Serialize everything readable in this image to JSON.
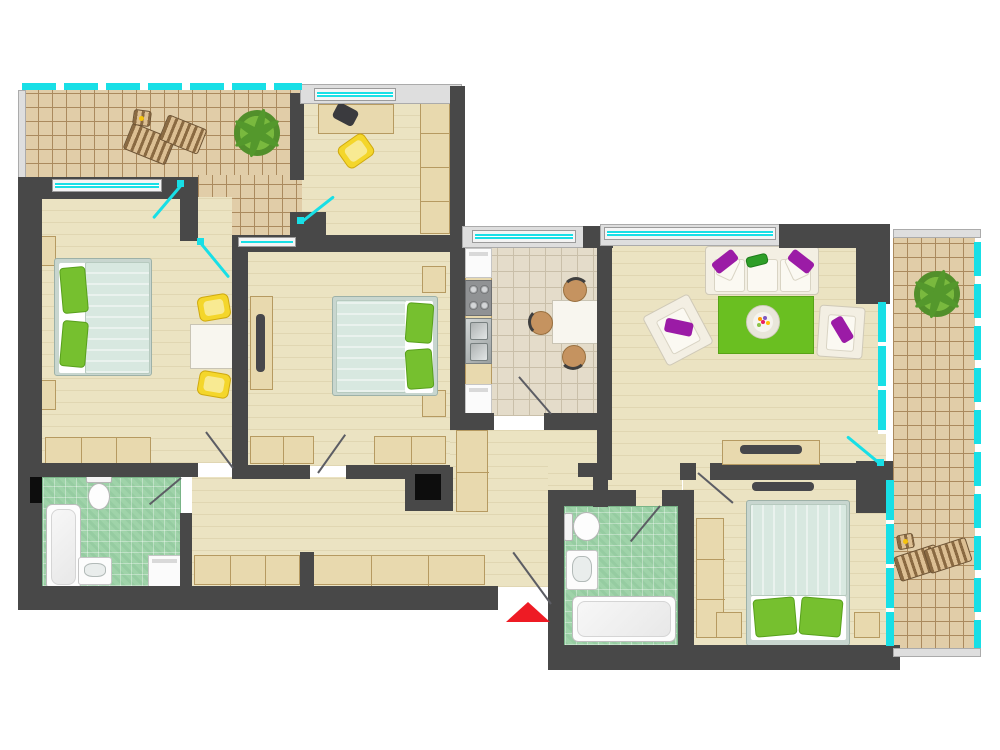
{
  "meta": {
    "kind": "apartment-floor-plan",
    "canvas_w": 1000,
    "canvas_h": 750,
    "visible_text": "none"
  },
  "palette": {
    "wall": "#484848",
    "terr": "#e1cda8",
    "terrline": "#ab8a5e",
    "wood": "#ebe3c2",
    "kit": "#e4dcca",
    "kitline": "#c9bfa9",
    "bath": "#9fd3a9",
    "glass": "#18dfe6",
    "furn": "#e8d9ae",
    "furnline": "#b69a61",
    "blanket": "#d8e8e0",
    "pillow": "#76c02f",
    "sofa": "#f3efe3",
    "purple": "#9b1ba6",
    "rug": "#6abf21",
    "yellow": "#f4d62b",
    "brown": "#c59360",
    "tv": "#47474b",
    "swing": "#5c5d64",
    "red": "#ee1b24"
  },
  "rooms": [
    {
      "id": "terrace-left",
      "name": "Terrace (top-left)",
      "floor": "tile",
      "furniture": [
        "lounge-chair",
        "lounge-chair",
        "side-table",
        "plant"
      ]
    },
    {
      "id": "study",
      "name": "Study",
      "floor": "wood",
      "furniture": [
        "desk",
        "laptop",
        "chair",
        "wardrobe"
      ]
    },
    {
      "id": "bedroom-1",
      "name": "Bedroom 1",
      "floor": "wood",
      "furniture": [
        "double-bed",
        "nightstand",
        "nightstand",
        "table",
        "chair",
        "chair",
        "wardrobe"
      ]
    },
    {
      "id": "bedroom-2",
      "name": "Bedroom 2",
      "floor": "wood",
      "furniture": [
        "double-bed",
        "nightstand",
        "nightstand",
        "dresser-tv",
        "wardrobe",
        "wardrobe"
      ]
    },
    {
      "id": "kitchen",
      "name": "Kitchen",
      "floor": "tile",
      "furniture": [
        "fridge",
        "stove",
        "sink",
        "cabinet",
        "dining-table",
        "chair",
        "chair",
        "chair"
      ]
    },
    {
      "id": "living-room",
      "name": "Living room",
      "floor": "wood",
      "furniture": [
        "sofa",
        "armchair",
        "armchair",
        "rug",
        "coffee-table",
        "tv-stand",
        "tv"
      ]
    },
    {
      "id": "terrace-right",
      "name": "Terrace (right)",
      "floor": "tile",
      "furniture": [
        "plant",
        "lounge-chair",
        "lounge-chair",
        "side-table"
      ]
    },
    {
      "id": "bedroom-3",
      "name": "Bedroom 3",
      "floor": "wood",
      "furniture": [
        "double-bed",
        "nightstand",
        "nightstand",
        "wardrobe",
        "tv"
      ]
    },
    {
      "id": "bathroom-1",
      "name": "Bathroom 1",
      "floor": "green-tile",
      "furniture": [
        "bathtub",
        "toilet",
        "sink",
        "washing-machine"
      ]
    },
    {
      "id": "bathroom-2",
      "name": "Bathroom 2",
      "floor": "green-tile",
      "furniture": [
        "bathtub",
        "toilet",
        "sink"
      ]
    },
    {
      "id": "hallway",
      "name": "Hallway",
      "floor": "wood",
      "furniture": [
        "cabinet-row",
        "cabinet-row",
        "tall-cabinet",
        "shaft"
      ]
    },
    {
      "id": "entrance",
      "name": "Entrance",
      "marker": "red-triangle"
    }
  ]
}
